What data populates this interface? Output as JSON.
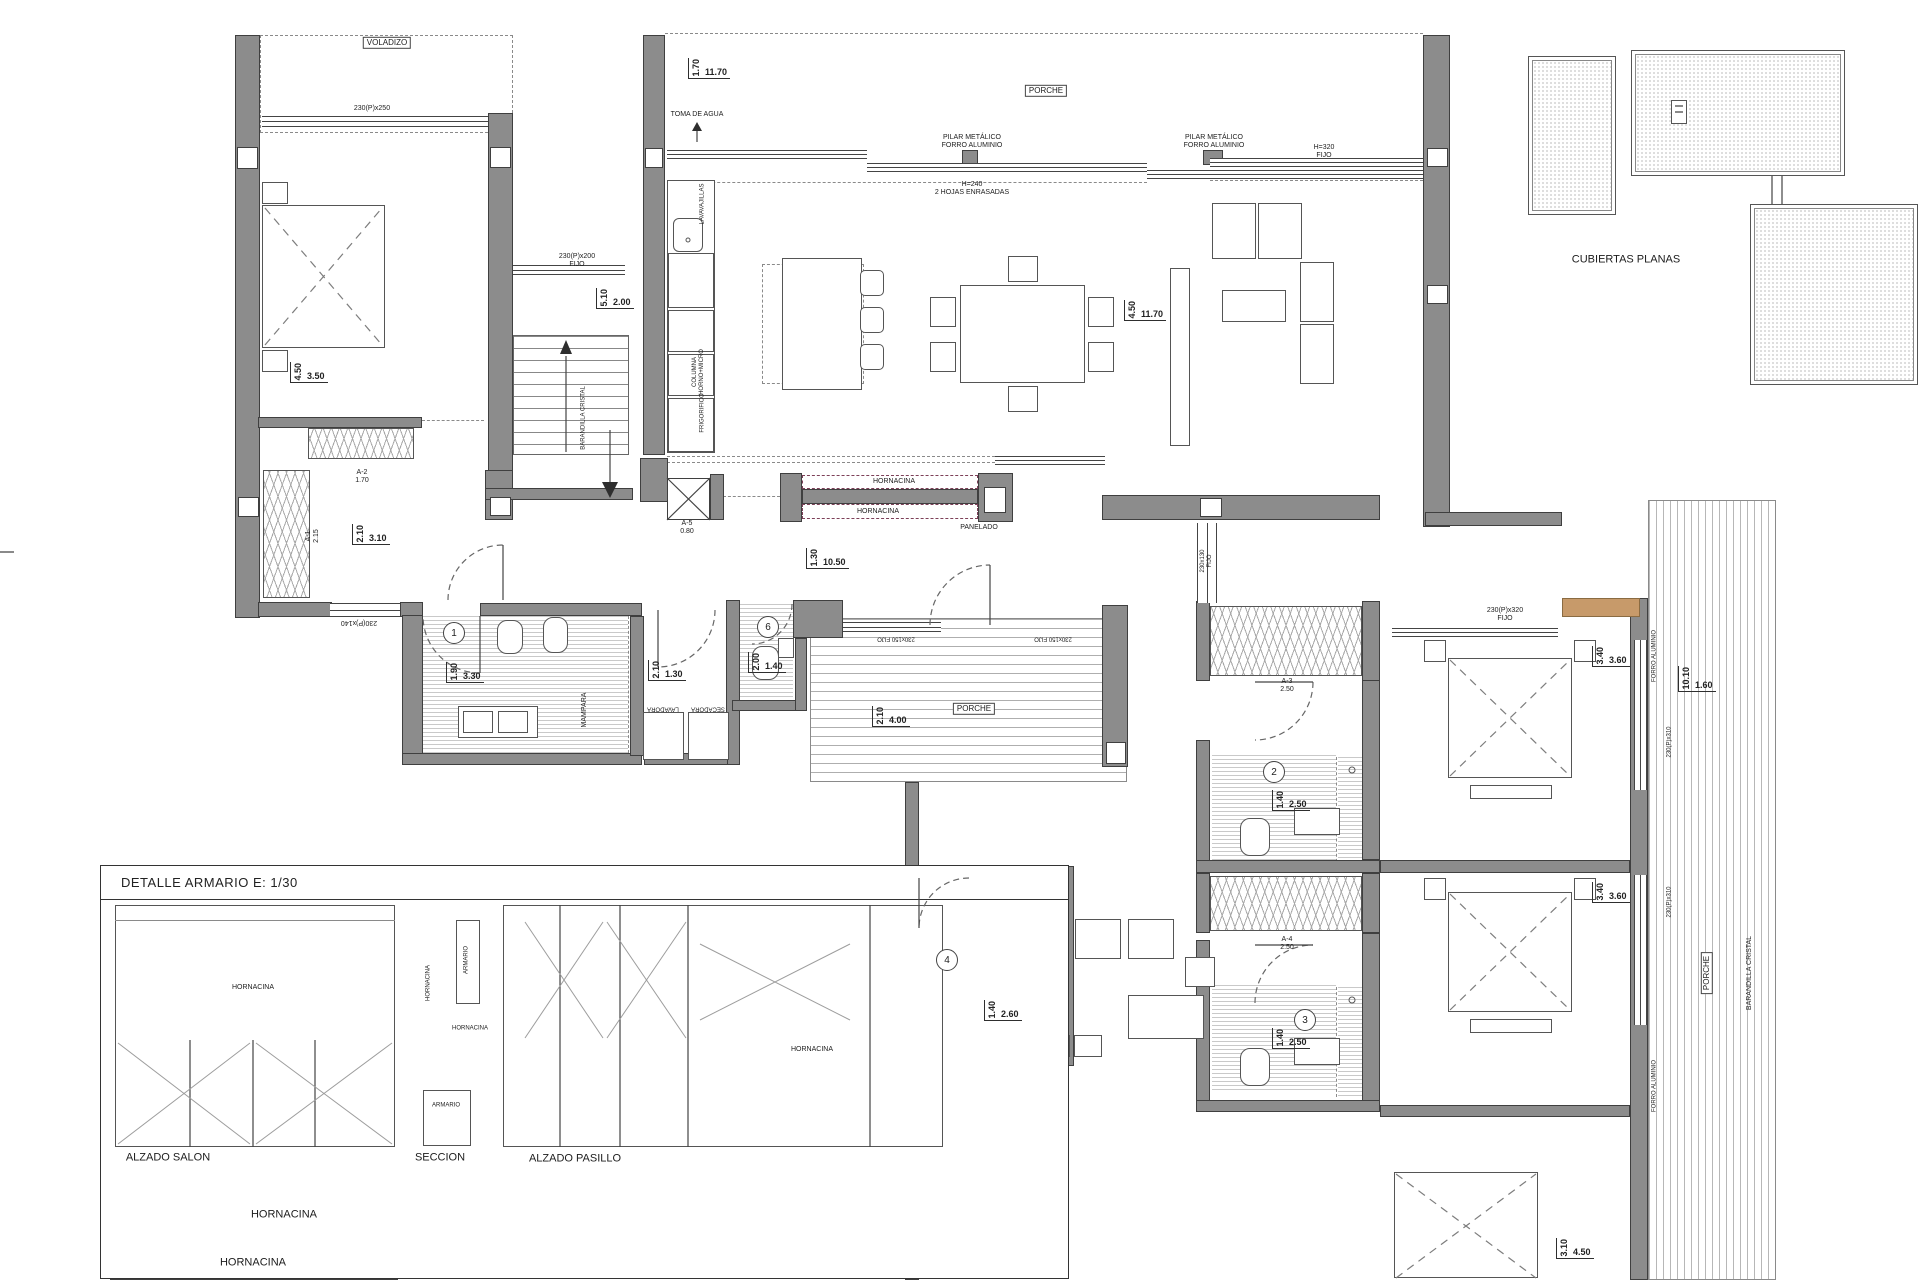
{
  "colors": {
    "wall": "#8c8c8c",
    "wall_outline": "#3f3f3f",
    "tan": "#c79a6a",
    "maroon": "#7d4058",
    "line": "#555555"
  },
  "detail_panel": {
    "title": "DETALLE ARMARIO E: 1/30"
  },
  "roof_plan": {
    "label": "CUBIERTAS PLANAS"
  },
  "annotations": [
    {
      "t": "VOLADIZO",
      "x": 387,
      "y": 43,
      "cls": "boxed"
    },
    {
      "t": "230(P)x250",
      "x": 372,
      "y": 109,
      "cls": "sm"
    },
    {
      "t": "230(P)x200\nFIJO",
      "x": 577,
      "y": 261,
      "cls": "sm"
    },
    {
      "t": "TOMA DE AGUA",
      "x": 697,
      "y": 115,
      "cls": "sm"
    },
    {
      "t": "PORCHE",
      "x": 1046,
      "y": 91,
      "cls": "boxed"
    },
    {
      "t": "PILAR METÁLICO\nFORRO ALUMINIO",
      "x": 972,
      "y": 142,
      "cls": "sm"
    },
    {
      "t": "PILAR METÁLICO\nFORRO ALUMINIO",
      "x": 1214,
      "y": 142,
      "cls": "sm"
    },
    {
      "t": "H=240\n2 HOJAS ENRASADAS",
      "x": 972,
      "y": 189,
      "cls": "sm"
    },
    {
      "t": "H=320\nFIJO",
      "x": 1324,
      "y": 152,
      "cls": "sm"
    },
    {
      "t": "A-2\n1.70",
      "x": 362,
      "y": 477,
      "cls": "sm"
    },
    {
      "t": "A-1\n2.15",
      "x": 313,
      "y": 536,
      "rot": -90,
      "cls": "sm"
    },
    {
      "t": "A-5\n0.80",
      "x": 687,
      "y": 528,
      "cls": "sm"
    },
    {
      "t": "230(P)x140",
      "x": 359,
      "y": 622,
      "rot": 180,
      "cls": "sm"
    },
    {
      "t": "HORNACINA",
      "x": 894,
      "y": 482,
      "cls": "sm"
    },
    {
      "t": "HORNACINA",
      "x": 878,
      "y": 512,
      "cls": "sm"
    },
    {
      "t": "PANELADO",
      "x": 979,
      "y": 528,
      "cls": "sm"
    },
    {
      "t": "MAMPARA",
      "x": 585,
      "y": 710,
      "rot": -90,
      "cls": "sm"
    },
    {
      "t": "LAVADORA",
      "x": 663,
      "y": 708,
      "rot": 180,
      "cls": "xs"
    },
    {
      "t": "SECADORA",
      "x": 708,
      "y": 708,
      "rot": 180,
      "cls": "xs"
    },
    {
      "t": "PORCHE",
      "x": 974,
      "y": 709,
      "cls": "boxed"
    },
    {
      "t": "230x150 FIJO",
      "x": 896,
      "y": 638,
      "rot": 180,
      "cls": "xs"
    },
    {
      "t": "230x150 FIJO",
      "x": 1053,
      "y": 638,
      "rot": 180,
      "cls": "xs"
    },
    {
      "t": "230(P)x320\nFIJO",
      "x": 1505,
      "y": 615,
      "cls": "sm"
    },
    {
      "t": "230x130\nFIJO",
      "x": 1207,
      "y": 561,
      "rot": -90,
      "cls": "xs"
    },
    {
      "t": "A-3\n2.50",
      "x": 1287,
      "y": 686,
      "cls": "sm"
    },
    {
      "t": "A-4\n2.50",
      "x": 1287,
      "y": 944,
      "cls": "sm"
    },
    {
      "t": "CUBIERTAS PLANAS",
      "x": 1626,
      "y": 260,
      "cls": "med"
    },
    {
      "t": "HORNACINA",
      "x": 253,
      "y": 988,
      "cls": "sm"
    },
    {
      "t": "HORNACINA",
      "x": 429,
      "y": 983,
      "rot": -90,
      "cls": "xs"
    },
    {
      "t": "ARMARIO",
      "x": 467,
      "y": 960,
      "rot": -90,
      "cls": "xs"
    },
    {
      "t": "HORNACINA",
      "x": 470,
      "y": 1029,
      "cls": "xs"
    },
    {
      "t": "HORNACINA",
      "x": 812,
      "y": 1050,
      "cls": "sm"
    },
    {
      "t": "ARMARIO",
      "x": 446,
      "y": 1106,
      "cls": "xs"
    },
    {
      "t": "ALZADO SALON",
      "x": 168,
      "y": 1158,
      "cls": "med"
    },
    {
      "t": "SECCION",
      "x": 440,
      "y": 1158,
      "cls": "med"
    },
    {
      "t": "ALZADO PASILLO",
      "x": 575,
      "y": 1159,
      "cls": "med"
    },
    {
      "t": "HORNACINA",
      "x": 284,
      "y": 1215,
      "cls": "med"
    },
    {
      "t": "HORNACINA",
      "x": 253,
      "y": 1263,
      "cls": "med"
    },
    {
      "t": "BARANDILLA CRISTAL",
      "x": 584,
      "y": 418,
      "rot": -90,
      "cls": "xs"
    },
    {
      "t": "BARANDILLA CRISTAL",
      "x": 1750,
      "y": 973,
      "rot": -90,
      "cls": "sm"
    },
    {
      "t": "LAVAVAJILLAS",
      "x": 703,
      "y": 204,
      "rot": -90,
      "cls": "xs"
    },
    {
      "t": "COLUMNA\nHORNO+MICRO",
      "x": 699,
      "y": 372,
      "rot": -90,
      "cls": "xs"
    },
    {
      "t": "FRIGORIFICO",
      "x": 703,
      "y": 413,
      "rot": -90,
      "cls": "xs"
    },
    {
      "t": "FORRO ALUMINIO",
      "x": 1655,
      "y": 656,
      "rot": -90,
      "cls": "xs"
    },
    {
      "t": "FORRO ALUMINIO",
      "x": 1655,
      "y": 1086,
      "rot": -90,
      "cls": "xs"
    },
    {
      "t": "230(P)x310",
      "x": 1670,
      "y": 742,
      "rot": -90,
      "cls": "xs"
    },
    {
      "t": "230(P)x310",
      "x": 1670,
      "y": 902,
      "rot": -90,
      "cls": "xs"
    },
    {
      "t": "PORCHE",
      "x": 1707,
      "y": 973,
      "rot": -90,
      "cls": "boxed"
    }
  ],
  "dimensions": [
    {
      "v": "4.50",
      "h": "3.50",
      "x": 290,
      "y": 362
    },
    {
      "v": "5.10",
      "h": "2.00",
      "x": 596,
      "y": 288
    },
    {
      "v": "2.10",
      "h": "3.10",
      "x": 352,
      "y": 524
    },
    {
      "v": "1.70",
      "h": "11.70",
      "x": 688,
      "y": 58
    },
    {
      "v": "4.50",
      "h": "11.70",
      "x": 1124,
      "y": 300
    },
    {
      "v": "1.90",
      "h": "3.30",
      "x": 446,
      "y": 662
    },
    {
      "v": "2.10",
      "h": "1.30",
      "x": 648,
      "y": 660
    },
    {
      "v": "2.00",
      "h": "1.40",
      "x": 748,
      "y": 652
    },
    {
      "v": "1.30",
      "h": "10.50",
      "x": 806,
      "y": 548
    },
    {
      "v": "2.10",
      "h": "4.00",
      "x": 872,
      "y": 706
    },
    {
      "v": "1.40",
      "h": "2.50",
      "x": 1272,
      "y": 790
    },
    {
      "v": "1.40",
      "h": "2.50",
      "x": 1272,
      "y": 1028
    },
    {
      "v": "3.40",
      "h": "3.60",
      "x": 1592,
      "y": 646
    },
    {
      "v": "3.40",
      "h": "3.60",
      "x": 1592,
      "y": 882
    },
    {
      "v": "10.10",
      "h": "1.60",
      "x": 1678,
      "y": 666
    },
    {
      "v": "1.40",
      "h": "2.60",
      "x": 984,
      "y": 1000
    },
    {
      "v": "3.10",
      "h": "4.50",
      "x": 1556,
      "y": 1238
    }
  ],
  "room_numbers": [
    {
      "n": "1",
      "x": 454,
      "y": 633
    },
    {
      "n": "6",
      "x": 768,
      "y": 627
    },
    {
      "n": "2",
      "x": 1274,
      "y": 772
    },
    {
      "n": "3",
      "x": 1305,
      "y": 1020
    },
    {
      "n": "4",
      "x": 947,
      "y": 960
    }
  ]
}
